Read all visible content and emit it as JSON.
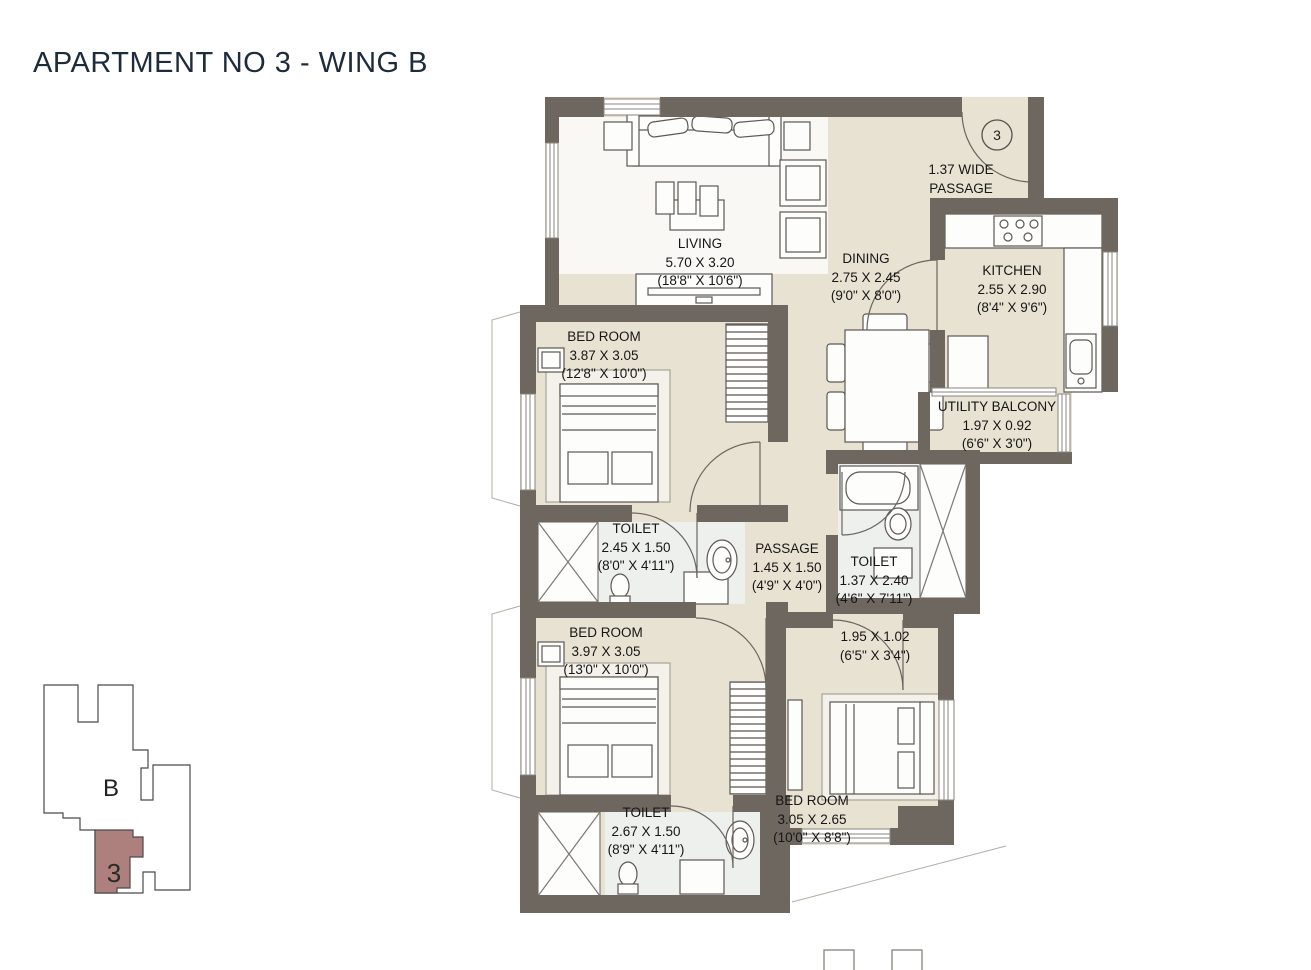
{
  "title": "APARTMENT NO 3 - WING B",
  "entrance": {
    "unit_circle": "3",
    "wide_passage_line1": "1.37 WIDE",
    "wide_passage_line2": "PASSAGE"
  },
  "rooms": {
    "living": {
      "name": "LIVING",
      "dim_m": "5.70 X 3.20",
      "dim_ft": "(18'8\" X 10'6\")"
    },
    "dining": {
      "name": "DINING",
      "dim_m": "2.75 X 2.45",
      "dim_ft": "(9'0\" X 8'0\")"
    },
    "kitchen": {
      "name": "KITCHEN",
      "dim_m": "2.55 X 2.90",
      "dim_ft": "(8'4\" X 9'6\")"
    },
    "utility_balcony": {
      "name": "UTILITY BALCONY",
      "dim_m": "1.97 X 0.92",
      "dim_ft": "(6'6\" X 3'0\")"
    },
    "bedroom_1": {
      "name": "BED ROOM",
      "dim_m": "3.87 X 3.05",
      "dim_ft": "(12'8\" X 10'0\")"
    },
    "toilet_1": {
      "name": "TOILET",
      "dim_m": "2.45 X 1.50",
      "dim_ft": "(8'0\" X 4'11\")"
    },
    "passage": {
      "name": "PASSAGE",
      "dim_m": "1.45 X 1.50",
      "dim_ft": "(4'9\" X 4'0\")"
    },
    "toilet_2": {
      "name": "TOILET",
      "dim_m": "1.37 X 2.40",
      "dim_ft": "(4'6\" X 7'11\")"
    },
    "bedroom_2": {
      "name": "BED ROOM",
      "dim_m": "3.97 X 3.05",
      "dim_ft": "(13'0\" X 10'0\")"
    },
    "toilet_3": {
      "name": "TOILET",
      "dim_m": "2.67 X 1.50",
      "dim_ft": "(8'9\" X 4'11\")"
    },
    "bedroom_3": {
      "name": "BED ROOM",
      "dim_m": "3.05 X 2.65",
      "dim_ft": "(10'0\" X 8'8\")"
    },
    "bedroom_3_entry": {
      "dim_m": "1.95 X 1.02",
      "dim_ft": "(6'5\" X 3'4\")"
    }
  },
  "keyplan": {
    "wing_label": "B",
    "unit_label": "3",
    "highlight_color": "#ad7f7d"
  },
  "colors": {
    "wall": "#6e6760",
    "floor": "#e8e2d2",
    "toilet_floor": "#edf0ec",
    "title_text": "#1e2b3c"
  }
}
